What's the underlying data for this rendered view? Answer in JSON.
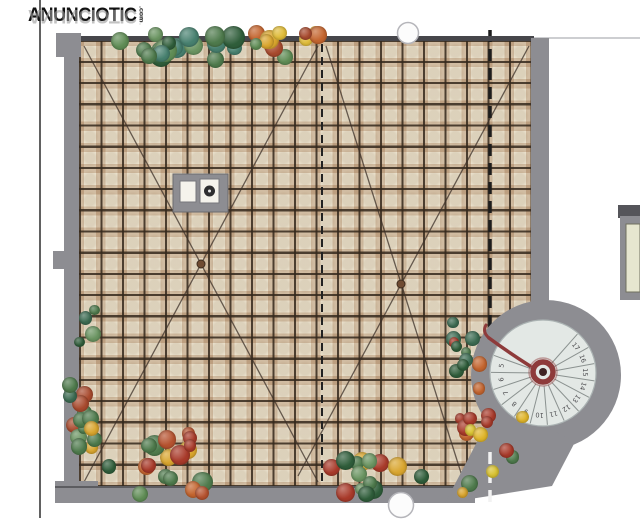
{
  "watermark": {
    "text": "ANUNCIOTIC",
    "suffix": ".com"
  },
  "plan": {
    "colors": {
      "wall": "#8d8d92",
      "wall_dark": "#46464b",
      "tile": "#efe7d3",
      "grout": "#34281c",
      "rust": "#8c5a30",
      "stair_light": "#e3e8e5",
      "railing": "#8e3b3b",
      "diagonal": "#3c3228",
      "vent_fill": "#fcfcfc",
      "vent_stroke": "#b5b5ba"
    },
    "stair": {
      "steps": [
        "17",
        "16",
        "15",
        "14",
        "13",
        "12",
        "11",
        "10",
        "9",
        "8",
        "7",
        "6",
        "5"
      ],
      "center_x": 543,
      "center_y": 373,
      "start_angle": -39,
      "angle_step": 19.1,
      "number_radius": 40,
      "inner_radius": 13,
      "outer_radius": 52,
      "number_color": "#4d4d50",
      "step_line_color": "#8b9290"
    },
    "plants": {
      "clusters": [
        {
          "name": "top-hedge",
          "x": 90,
          "y": 34,
          "w": 170,
          "h": 26,
          "count": 18,
          "rmin": 7,
          "rmax": 12,
          "seed": 11,
          "palette": [
            "#4e7a4c",
            "#3c6b52",
            "#5f8c55",
            "#47806f",
            "#2f5d3a",
            "#6a9461"
          ]
        },
        {
          "name": "top-flowers",
          "x": 256,
          "y": 32,
          "w": 80,
          "h": 28,
          "count": 12,
          "rmin": 6,
          "rmax": 10,
          "seed": 22,
          "palette": [
            "#d9a52e",
            "#e0bc3a",
            "#c4652f",
            "#a84a2e",
            "#5f8c55",
            "#d9a52e"
          ]
        },
        {
          "name": "left-vines",
          "x": 68,
          "y": 298,
          "w": 30,
          "h": 155,
          "count": 20,
          "rmin": 5,
          "rmax": 9,
          "seed": 33,
          "palette": [
            "#4e7a4c",
            "#3c6b52",
            "#2f5d3a",
            "#6a9461",
            "#a84a2e",
            "#d9a52e",
            "#4e7a4c"
          ]
        },
        {
          "name": "bottom-left",
          "x": 105,
          "y": 422,
          "w": 100,
          "h": 72,
          "count": 18,
          "rmin": 6,
          "rmax": 11,
          "seed": 44,
          "palette": [
            "#4e7a4c",
            "#a83a2a",
            "#d9a52e",
            "#c4652f",
            "#2f5d3a",
            "#b5522f",
            "#5f8c55"
          ]
        },
        {
          "name": "bottom-middle",
          "x": 325,
          "y": 460,
          "w": 108,
          "h": 34,
          "count": 14,
          "rmin": 6,
          "rmax": 11,
          "seed": 55,
          "palette": [
            "#4e7a4c",
            "#a83a2a",
            "#d9a52e",
            "#2f5d3a",
            "#6a9461"
          ]
        },
        {
          "name": "stair-side",
          "x": 448,
          "y": 322,
          "w": 32,
          "h": 112,
          "count": 14,
          "rmin": 5,
          "rmax": 9,
          "seed": 66,
          "palette": [
            "#4e7a4c",
            "#2f5d3a",
            "#a83a2a",
            "#6a9461",
            "#3c6b52",
            "#c4652f"
          ]
        },
        {
          "name": "stair-edge",
          "x": 462,
          "y": 412,
          "w": 62,
          "h": 86,
          "count": 12,
          "rmin": 5,
          "rmax": 9,
          "seed": 77,
          "palette": [
            "#d9c232",
            "#e0b52a",
            "#a83a2a",
            "#4e7a4c",
            "#d9a52e"
          ]
        }
      ]
    }
  }
}
